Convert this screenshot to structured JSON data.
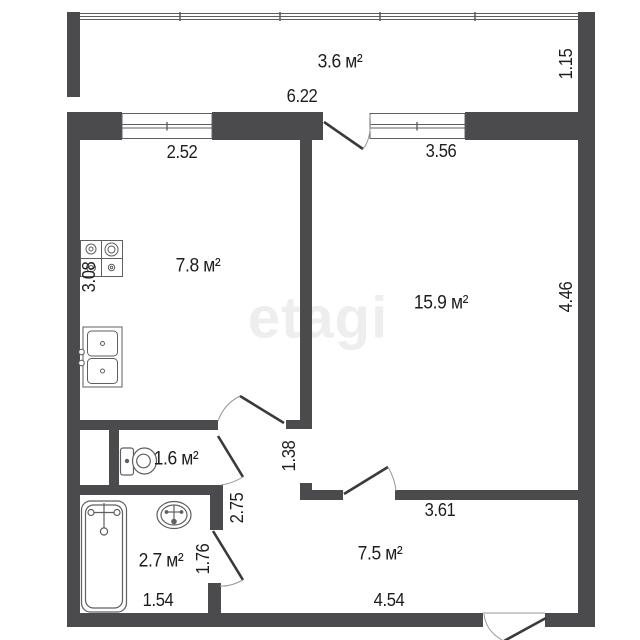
{
  "plan": {
    "watermark": "etagi",
    "balcony": {
      "area": "3.6 м²",
      "length": "6.22",
      "depth": "1.15"
    },
    "kitchen": {
      "area": "7.8 м²",
      "window": "2.52",
      "depth": "3.08"
    },
    "living": {
      "area": "15.9 м²",
      "window": "3.56",
      "depth": "4.46",
      "wall": "3.61",
      "passage": "1.38"
    },
    "toilet": {
      "area": "1.6 м²"
    },
    "bathroom": {
      "area": "2.7 м²",
      "width": "1.54",
      "door": "1.76",
      "corridor": "2.75"
    },
    "hallway": {
      "area": "7.5 м²",
      "length": "4.54"
    }
  },
  "colors": {
    "wall": "#4b4b4d",
    "fixture_line": "#5f5f63",
    "door_leaf": "#3a3a3c",
    "door_arc": "#97979b",
    "text": "#1d1d1f",
    "watermark": "#efeeee"
  }
}
